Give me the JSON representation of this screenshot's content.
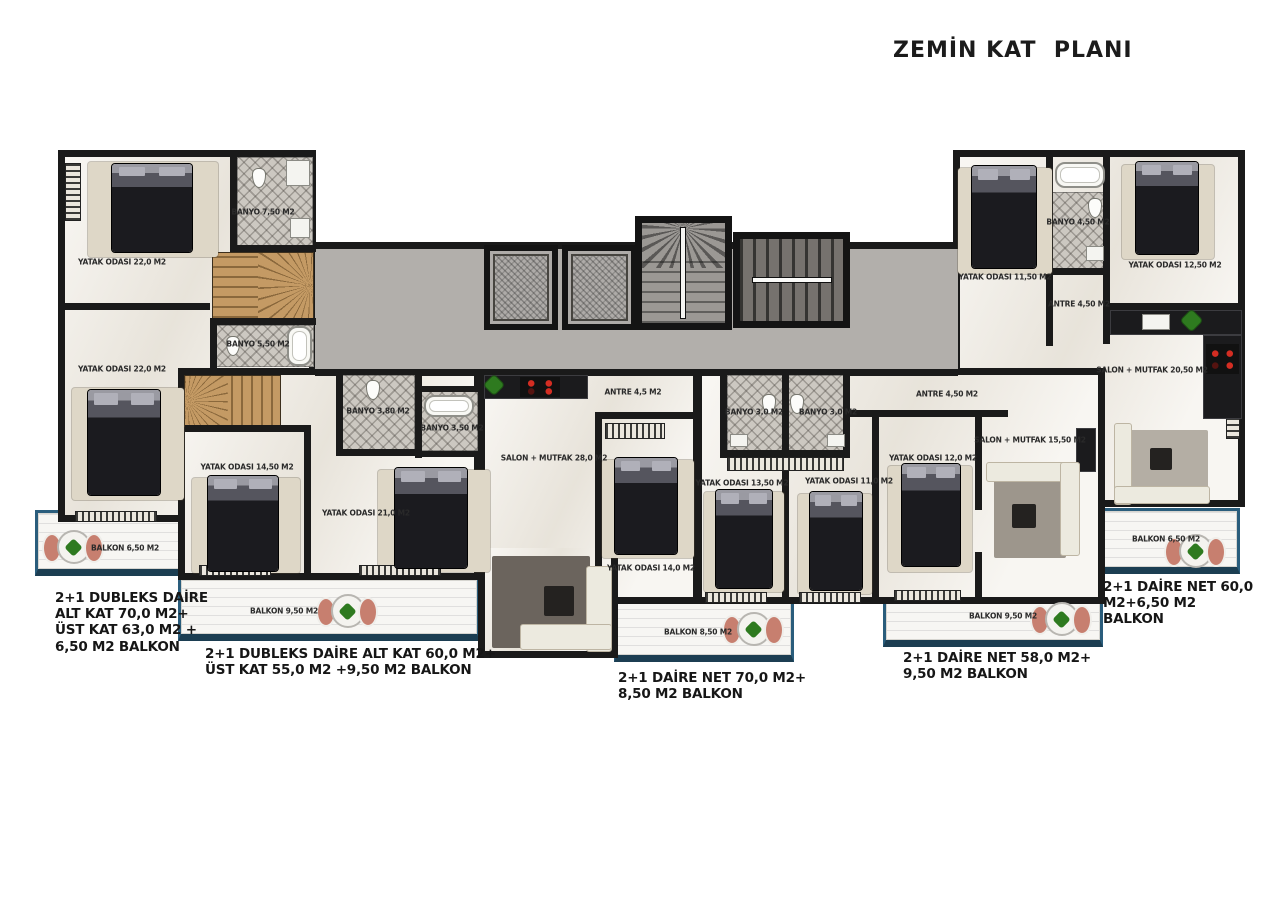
{
  "title": "ZEMİN KAT  PLANI",
  "colors": {
    "wall": "#1a1a1a",
    "floor": "#f1ede5",
    "corridor": "#b2afab",
    "balcony_border": "#2a5d7c",
    "wood_stairs": "#c49a64",
    "tile": "#ccc8c1",
    "chair": "#c77f6f",
    "plant": "#2e7a1f"
  },
  "apartments": [
    {
      "name": "duplex-left",
      "rooms": {
        "bedroom1": "YATAK ODASI 22,0 M2",
        "bathroom1": "BANYO 7,50 M2",
        "bedroom2": "YATAK ODASI 22,0 M2",
        "bathroom2": "BANYO 5,50 M2",
        "balcony": "BALKON 6,50 M2"
      },
      "summary": "2+1 DUBLEKS DAİRE\nALT KAT 70,0 M2+\nÜST KAT 63,0 M2 +\n6,50 M2 BALKON"
    },
    {
      "name": "duplex-mid-left",
      "rooms": {
        "bedroom1": "YATAK ODASI 14,50 M2",
        "bedroom2": "YATAK ODASI 21,0 M2",
        "bathroom1": "BANYO 3,80 M2",
        "bathroom2": "BANYO 3,50 M2",
        "balcony": "BALKON 9,50 M2"
      },
      "summary": "2+1 DUBLEKS DAİRE ALT KAT 60,0 M2+\nÜST KAT 55,0 M2 +9,50 M2 BALKON"
    },
    {
      "name": "center",
      "rooms": {
        "entry": "ANTRE 4,5 M2",
        "living": "SALON + MUTFAK 28,0 M2",
        "bedroom1": "YATAK ODASI 14,0 M2",
        "bedroom2": "YATAK ODASI 13,50 M2",
        "bathroom": "BANYO 3,0 M2",
        "balcony": "BALKON 8,50 M2"
      },
      "summary": "2+1 DAİRE NET 70,0 M2+\n8,50 M2 BALKON"
    },
    {
      "name": "center-right",
      "rooms": {
        "bathroom": "BANYO 3,0 M2",
        "bedroom1": "YATAK ODASI 11,0 M2",
        "bedroom2": "YATAK ODASI 12,0 M2",
        "entry": "ANTRE 4,50 M2",
        "living": "SALON + MUTFAK 15,50 M2",
        "balcony": "BALKON 9,50 M2"
      },
      "summary": "2+1 DAİRE NET 58,0 M2+\n9,50 M2 BALKON"
    },
    {
      "name": "top-right",
      "rooms": {
        "bedroom1": "YATAK ODASI 11,50 M2",
        "bathroom": "BANYO 4,50 M2",
        "bedroom2": "YATAK ODASI 12,50 M2",
        "entry": "ANTRE 4,50 M2",
        "living": "SALON + MUTFAK 20,50 M2",
        "balcony": "BALKON 6,50 M2"
      },
      "summary": "2+1 DAİRE NET 60,0 M2+6,50 M2\nBALKON"
    }
  ]
}
